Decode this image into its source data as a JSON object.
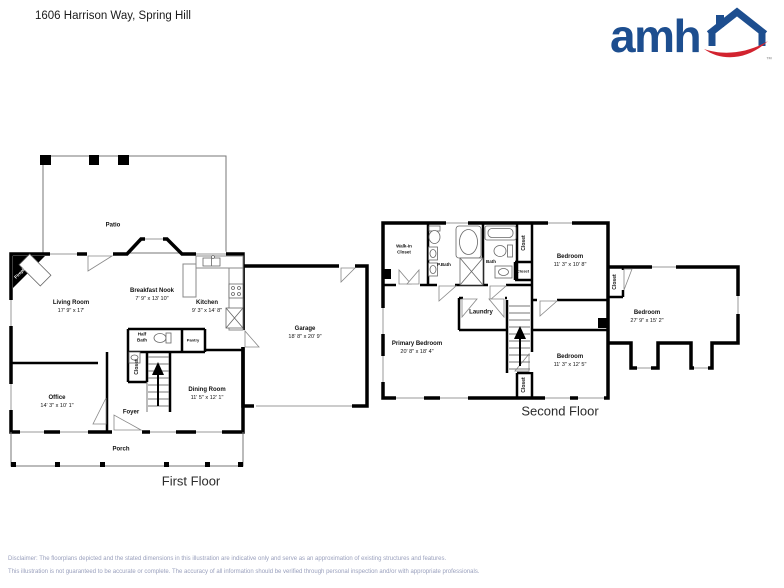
{
  "header": {
    "title": "1606 Harrison Way, Spring Hill",
    "logo_text": "amh",
    "logo_tm": "™",
    "logo_blue": "#1d4e8f",
    "logo_red": "#d2232f"
  },
  "common": {
    "closet": "Closet"
  },
  "first_floor": {
    "caption": "First Floor",
    "rooms": {
      "patio": {
        "name": "Patio"
      },
      "fireplace": {
        "name": "Fireplace"
      },
      "living_room": {
        "name": "Living Room",
        "dims": "17' 9\" x 17'"
      },
      "breakfast_nook": {
        "name": "Breakfast Nook",
        "dims": "7' 9\" x 13' 10\""
      },
      "kitchen": {
        "name": "Kitchen",
        "dims": "9' 3\" x 14' 8\""
      },
      "half_bath": {
        "name": "Half Bath"
      },
      "pantry": {
        "name": "Pantry"
      },
      "office": {
        "name": "Office",
        "dims": "14' 3\" x 10' 1\""
      },
      "dining_room": {
        "name": "Dining Room",
        "dims": "11' 5\" x 12' 1\""
      },
      "foyer": {
        "name": "Foyer"
      },
      "porch": {
        "name": "Porch"
      },
      "garage": {
        "name": "Garage",
        "dims": "18' 8\" x 20' 9\""
      }
    }
  },
  "second_floor": {
    "caption": "Second Floor",
    "rooms": {
      "walk_in_closet": {
        "name": "Walk-In Closet"
      },
      "p_bath": {
        "name": "P.Bath"
      },
      "bath": {
        "name": "Bath"
      },
      "laundry": {
        "name": "Laundry"
      },
      "bedroom_top": {
        "name": "Bedroom",
        "dims": "11' 3\" x 10' 8\""
      },
      "bedroom_right": {
        "name": "Bedroom",
        "dims": "27' 9\" x 15' 2\""
      },
      "bedroom_bottom": {
        "name": "Bedroom",
        "dims": "11' 3\" x 12' 5\""
      },
      "primary_bedroom": {
        "name": "Primary Bedroom",
        "dims": "20' 8\" x 18' 4\""
      }
    }
  },
  "footer": {
    "disclaimer_line1": "Disclaimer: The floorplans depicted and the stated dimensions in this illustration are indicative only and serve as an approximation of existing structures and features.",
    "disclaimer_line2": "This illustration is not guaranteed to be accurate or complete. The accuracy of all information should be verified through personal inspection and/or with appropriate professionals."
  }
}
